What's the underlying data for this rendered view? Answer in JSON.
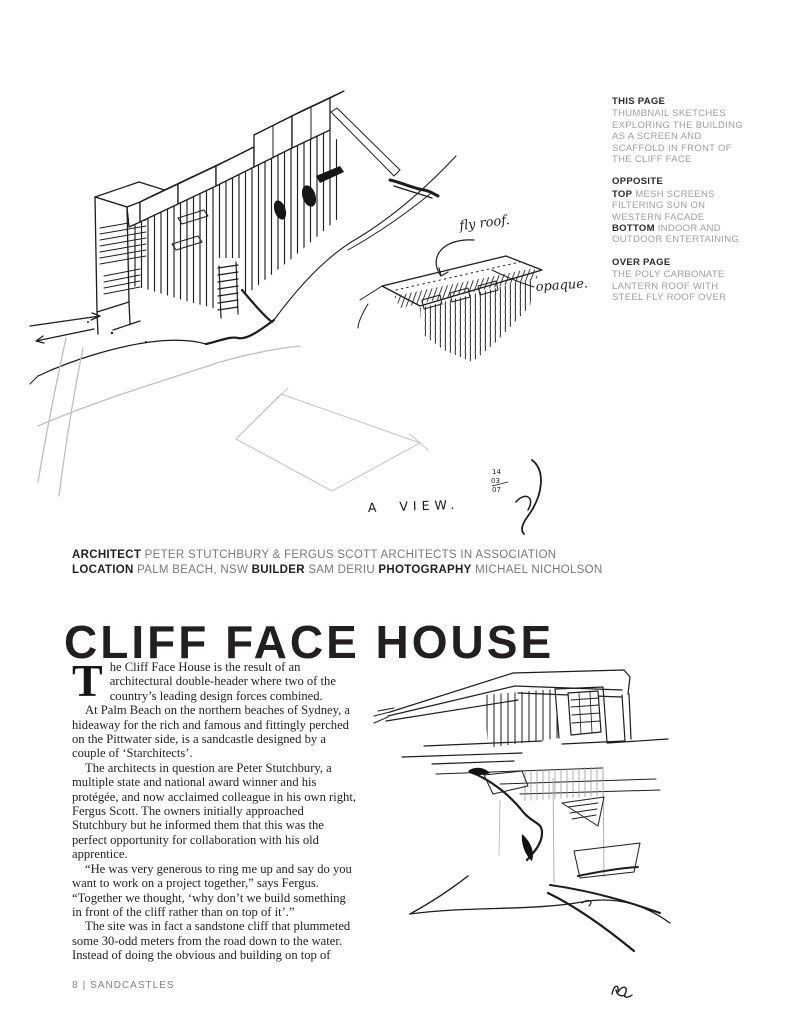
{
  "page": {
    "title": "CLIFF FACE HOUSE",
    "footer": {
      "page_number": "8",
      "divider": "|",
      "book_title": "SANDCASTLES"
    }
  },
  "captions": {
    "this_page": {
      "heading": "THIS PAGE",
      "text": "THUMBNAIL SKETCHES EXPLORING THE BUILDING AS A SCREEN AND SCAFFOLD IN FRONT OF THE CLIFF FACE"
    },
    "opposite": {
      "heading": "OPPOSITE",
      "top_label": "TOP",
      "top_text": " MESH SCREENS FILTERING SUN ON WESTERN FACADE",
      "bottom_label": "BOTTOM",
      "bottom_text": " INDOOR AND OUTDOOR ENTERTAINING"
    },
    "over_page": {
      "heading": "OVER PAGE",
      "text": "THE POLY CARBONATE LANTERN ROOF WITH STEEL FLY ROOF OVER"
    }
  },
  "credits": {
    "architect_label": "ARCHITECT",
    "architect_value": " PETER STUTCHBURY & FERGUS SCOTT ARCHITECTS IN ASSOCIATION",
    "location_label": "LOCATION",
    "location_value": " PALM BEACH, NSW ",
    "builder_label": "BUILDER",
    "builder_value": " SAM DERIU ",
    "photography_label": "PHOTOGRAPHY",
    "photography_value": " MICHAEL NICHOLSON"
  },
  "article": {
    "dropcap": "T",
    "paragraphs": [
      "he Cliff Face House is the result of an architectural double-header where two of the country’s leading design forces combined.",
      "At Palm Beach on the northern beaches of Sydney, a hideaway for the rich and famous and fittingly perched on the Pittwater side, is a sandcastle designed by a couple of ‘Starchitects’.",
      "The architects in question are Peter Stutchbury, a multiple state and national award winner and his protégée, and now acclaimed colleague in his own right, Fergus Scott. The owners initially approached Stutchbury but he informed them that this was the perfect opportunity for collaboration with his old apprentice.",
      "“He was very generous to ring me up and say do you want to work on a project together,” says Fergus. “Together we thought, ‘why don’t we build something in front of the cliff rather than on top of it’.”",
      "The site was in fact a sandstone cliff that plummeted some 30-odd meters from the road down to the water. Instead of doing the obvious and building on top of"
    ]
  },
  "sketch": {
    "fly_roof_label": "fly roof.",
    "opaque_label": "opaque.",
    "view_label": "A VIEW.",
    "signature_date": [
      "14",
      "03",
      "07"
    ]
  },
  "colors": {
    "ink": "#1d1d1b",
    "heading_dark": "#231f20",
    "caption_gray": "#9d9fa2",
    "credit_gray": "#77787b",
    "footer_gray": "#808285",
    "pencil_gray": "#c6c6c8"
  }
}
